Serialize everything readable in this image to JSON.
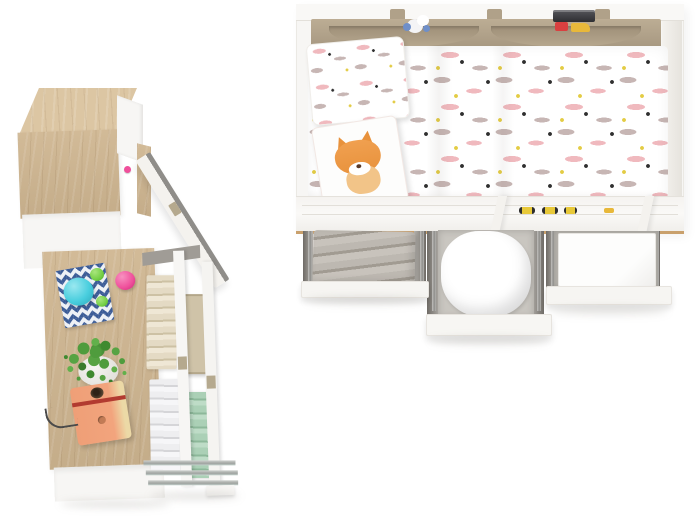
{
  "meta": {
    "description": "Overhead 3D product render of a kids bedroom furniture set: a single bed with patterned duvet, pillow and fox-print cushion, a tan hanging pocket organizer holding a plush toy and a toy truck, three pulled-out under-bed storage drawers (gray blanket, white pillow, white linens), plus an oak wardrobe with an open white door, an oak desk with decor (chevron mat, teapot ornaments, potted plant, orange toy radio) and an open storage drawer with folded textiles.",
    "view": "top-down",
    "visible_text": "none"
  },
  "palette": {
    "background": "#ffffff",
    "wood": "#cfb691",
    "wood_light": "#dcc6a3",
    "wood_dark": "#b99b74",
    "wood_edge": "#c9a06c",
    "white_furniture": "#f7f6f4",
    "white_shade": "#e9e6e1",
    "tan_organizer": "#b0a189",
    "tan_dark": "#8d7f67",
    "duvet_pink": "#f0b9be",
    "duvet_taupe": "#c7b6b4",
    "duvet_yellow": "#e3cc45",
    "duvet_black": "#303030",
    "gray_blanket": "#b3aea7",
    "metal": "#a8a7a4",
    "metal_dark": "#7e7d7a",
    "green_towel": "#a9cfb4",
    "beige_linen": "#ddd2bb",
    "beige_box": "#cfc3a8",
    "towel_white": "#e9e9ec",
    "chevron_navy": "#3c5c97",
    "ball_cyan": "#49cede",
    "ball_green": "#74cf45",
    "ball_pink": "#ef4f9b",
    "plant_green": "#4f9c3d",
    "radio_orange": "#f2a47d",
    "radio_red": "#b23b30",
    "fox_orange": "#e8923c",
    "shadow": "rgba(120,115,108,0.18)"
  },
  "objects": {
    "bed": {
      "label": "single bed with storage, top view"
    },
    "organizer": {
      "label": "tan hanging pocket organizer with plush toy and toy truck"
    },
    "duvet": {
      "label": "duvet with pink and taupe watercolor pattern"
    },
    "pillow": {
      "label": "patterned pillow"
    },
    "fox_cushion": {
      "label": "white cushion with fox print"
    },
    "rail_cars": {
      "label": "small yellow toy cars on safety rail"
    },
    "drawer_left": {
      "label": "under-bed drawer with folded gray blanket"
    },
    "drawer_middle": {
      "label": "under-bed drawer with white pillow"
    },
    "drawer_right": {
      "label": "under-bed drawer with white linens"
    },
    "wardrobe": {
      "label": "oak wardrobe column with open white door"
    },
    "desk": {
      "label": "oak desk with decor items"
    },
    "chevron_mat": {
      "label": "navy chevron mat with teapot ornaments"
    },
    "plant": {
      "label": "potted green plant"
    },
    "radio": {
      "label": "orange toy radio with power cord"
    },
    "storage": {
      "label": "open storage drawer with folded linens and towels"
    }
  }
}
